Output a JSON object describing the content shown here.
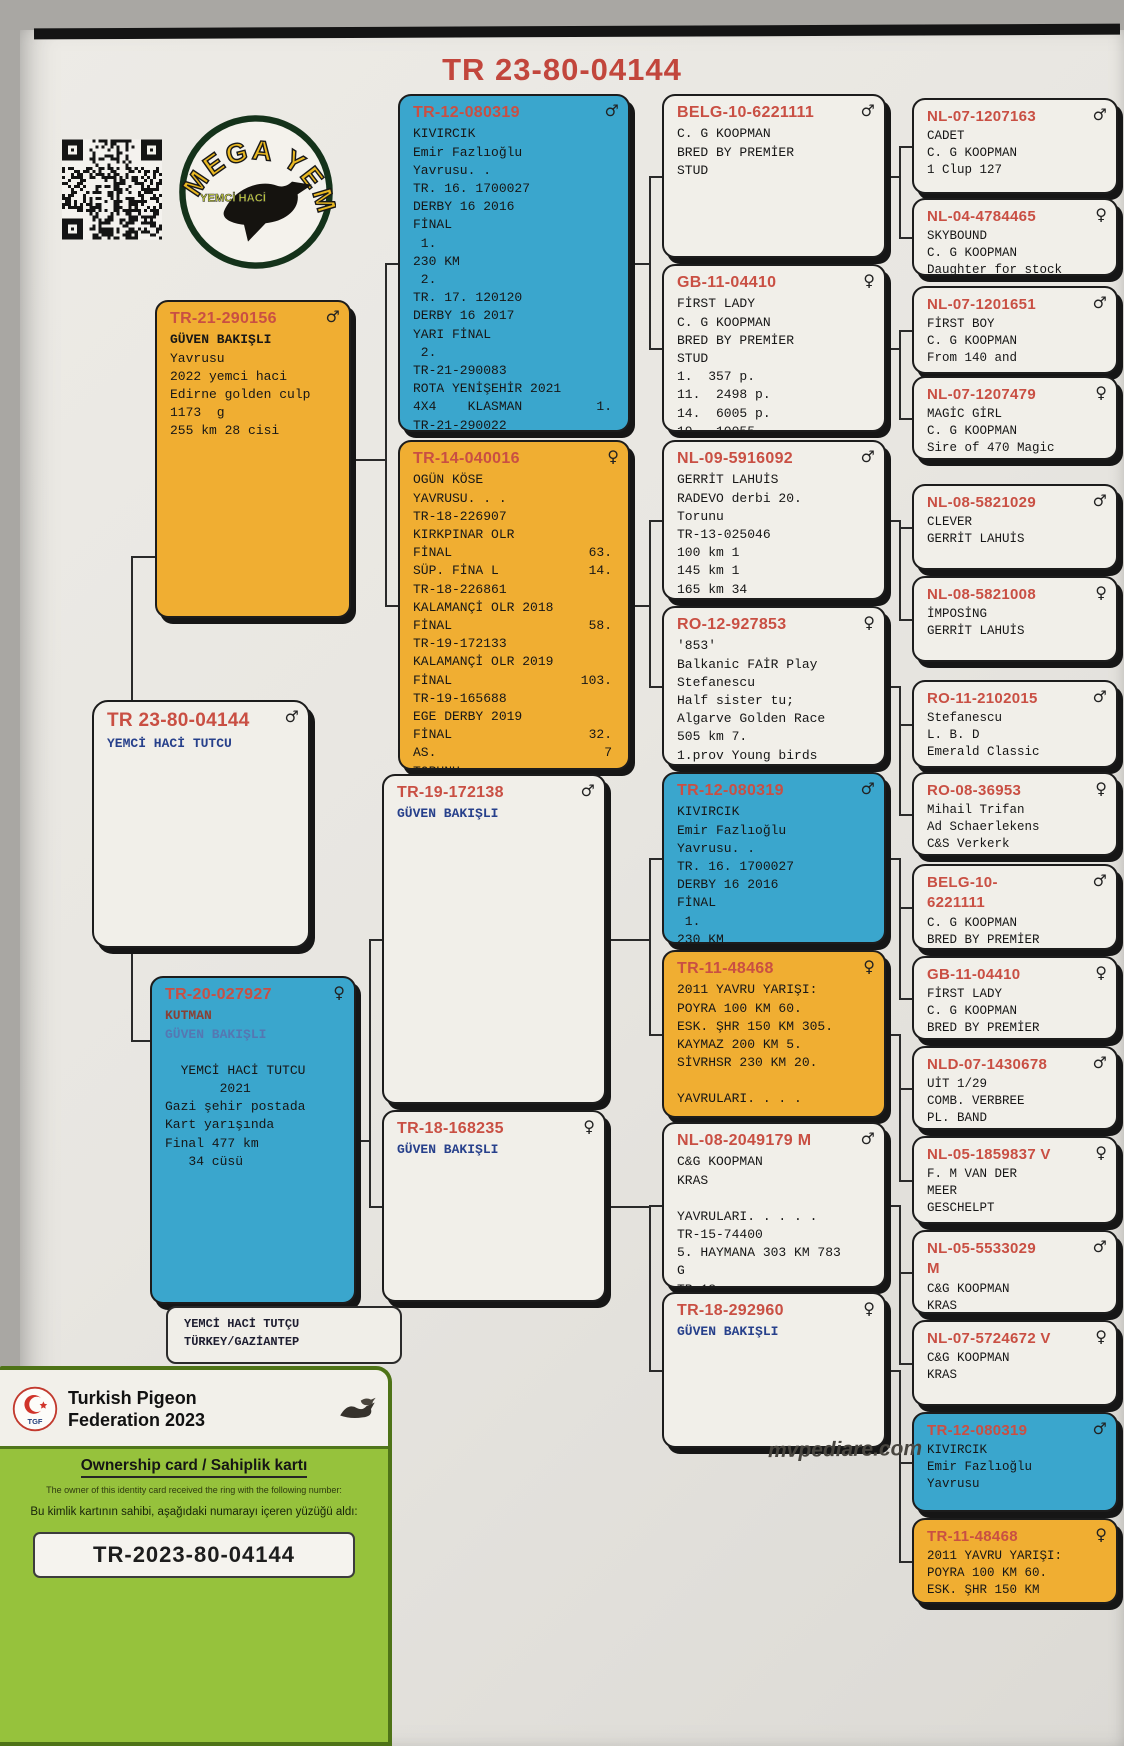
{
  "page": {
    "title": "TR 23-80-04144",
    "site": "mvpediare.com"
  },
  "logo": {
    "brand_top": "MEGA YEM",
    "brand_bottom": "YEMCİ HACİ"
  },
  "owner_box": {
    "line1": "YEMCİ HACİ TUTÇU",
    "line2": "TÜRKEY/GAZİANTEP"
  },
  "card": {
    "logo_text": "TGF",
    "federation_line1": "Turkish Pigeon",
    "federation_line2": "Federation 2023",
    "ownership_title": "Ownership card / Sahiplik kartı",
    "desc_en": "The owner of this identity card received the ring with the following number:",
    "desc_tr": "Bu kimlik kartının sahibi, aşağıdaki numarayı içeren yüzüğü aldı:",
    "ring_number": "TR-2023-80-04144"
  },
  "colors": {
    "blue": "#3aa6cd",
    "orange": "#f0ae32",
    "ring_red": "#c94f43",
    "navy": "#27408b"
  },
  "pedigree": {
    "extra_segments": [
      {
        "o": "v",
        "x": 131,
        "y": 556,
        "len": 146
      },
      {
        "o": "h",
        "x": 131,
        "y": 556,
        "len": 24
      },
      {
        "o": "v",
        "x": 131,
        "y": 948,
        "len": 92
      },
      {
        "o": "h",
        "x": 131,
        "y": 1040,
        "len": 20
      }
    ],
    "boxes": [
      {
        "id": "b1",
        "col": 1,
        "color": "orange",
        "sex": "m",
        "x": 155,
        "y": 300,
        "w": 196,
        "h": 318,
        "ring": "TR-21-290156",
        "parents": [
          "b4",
          "b5"
        ],
        "lines": [
          {
            "t": "GÜVEN BAKIŞLI",
            "s": "bold"
          },
          {
            "t": "Yavrusu"
          },
          {
            "t": "2022 yemci haci"
          },
          {
            "t": "Edirne golden culp"
          },
          {
            "t": "1173  g"
          },
          {
            "t": "255 km 28 cisi"
          }
        ]
      },
      {
        "id": "b2",
        "col": 1,
        "color": "white",
        "sex": "m",
        "x": 92,
        "y": 700,
        "w": 218,
        "h": 248,
        "rs": 19,
        "ring": "TR 23-80-04144",
        "parents": [],
        "lines": [
          {
            "t": "YEMCİ HACİ TUTCU",
            "s": "navy"
          }
        ]
      },
      {
        "id": "b3",
        "col": 1,
        "color": "blue",
        "sex": "f",
        "x": 150,
        "y": 976,
        "w": 206,
        "h": 328,
        "ring": "TR-20-027927",
        "parents": [
          "b6",
          "b7"
        ],
        "lines": [
          {
            "t": "KUTMAN",
            "s": "darkred"
          },
          {
            "t": "GÜVEN BAKIŞLI",
            "s": "navyfade"
          },
          {
            "t": ""
          },
          {
            "t": "  YEMCİ HACİ TUTCU"
          },
          {
            "t": "       2021"
          },
          {
            "t": "Gazi şehir postada"
          },
          {
            "t": "Kart yarışında"
          },
          {
            "t": "Final 477 km"
          },
          {
            "t": "   34 cüsü"
          }
        ]
      },
      {
        "id": "b4",
        "col": 2,
        "color": "blue",
        "sex": "m",
        "x": 398,
        "y": 94,
        "w": 232,
        "h": 338,
        "ring": "TR-12-080319",
        "parents": [
          "b8",
          "b9"
        ],
        "lines": [
          {
            "t": "KIVIRCIK"
          },
          {
            "t": "Emir Fazlıoğlu"
          },
          {
            "t": "Yavrusu. ."
          },
          {
            "t": "TR. 16. 1700027"
          },
          {
            "t": "DERBY 16 2016"
          },
          {
            "t": "FİNAL"
          },
          {
            "t": " 1."
          },
          {
            "t": "230 KM"
          },
          {
            "t": " 2."
          },
          {
            "t": "TR. 17. 120120"
          },
          {
            "t": "DERBY 16 2017"
          },
          {
            "t": "YARI FİNAL"
          },
          {
            "t": " 2."
          },
          {
            "t": "TR-21-290083"
          },
          {
            "t": "ROTA YENİŞEHİR 2021"
          },
          {
            "t": "4X4    KLASMAN",
            "r": "1."
          },
          {
            "t": "TR-21-290022"
          }
        ]
      },
      {
        "id": "b5",
        "col": 2,
        "color": "orange",
        "sex": "f",
        "x": 398,
        "y": 440,
        "w": 232,
        "h": 330,
        "ring": "TR-14-040016",
        "parents": [
          "b10",
          "b11"
        ],
        "lines": [
          {
            "t": "OGÜN KÖSE"
          },
          {
            "t": "YAVRUSU. . ."
          },
          {
            "t": "TR-18-226907"
          },
          {
            "t": "KIRKPINAR OLR"
          },
          {
            "t": "FİNAL",
            "r": "63."
          },
          {
            "t": "SÜP. FİNA L",
            "r": "14."
          },
          {
            "t": "TR-18-226861"
          },
          {
            "t": "KALAMANÇİ OLR 2018"
          },
          {
            "t": "FİNAL",
            "r": "58."
          },
          {
            "t": "TR-19-172133"
          },
          {
            "t": "KALAMANÇİ OLR 2019"
          },
          {
            "t": "FİNAL",
            "r": "103."
          },
          {
            "t": "TR-19-165688"
          },
          {
            "t": "EGE DERBY 2019"
          },
          {
            "t": "FİNAL",
            "r": "32."
          },
          {
            "t": "AS.",
            "r": "7"
          },
          {
            "t": "TORUNU"
          }
        ]
      },
      {
        "id": "b6",
        "col": 2,
        "color": "white",
        "sex": "m",
        "x": 382,
        "y": 774,
        "w": 224,
        "h": 330,
        "ring": "TR-19-172138",
        "parents": [
          "b12",
          "b13"
        ],
        "lines": [
          {
            "t": "GÜVEN BAKIŞLI",
            "s": "navy"
          }
        ]
      },
      {
        "id": "b7",
        "col": 2,
        "color": "white",
        "sex": "f",
        "x": 382,
        "y": 1110,
        "w": 224,
        "h": 192,
        "ring": "TR-18-168235",
        "parents": [
          "b14",
          "b15"
        ],
        "lines": [
          {
            "t": "GÜVEN BAKIŞLI",
            "s": "navy"
          }
        ]
      },
      {
        "id": "b8",
        "col": 3,
        "color": "white",
        "sex": "m",
        "x": 662,
        "y": 94,
        "w": 224,
        "h": 164,
        "ring": "BELG-10-6221111",
        "parents": [
          "b16",
          "b17"
        ],
        "lines": [
          {
            "t": "C. G KOOPMAN"
          },
          {
            "t": "BRED BY PREMİER"
          },
          {
            "t": "STUD"
          }
        ]
      },
      {
        "id": "b9",
        "col": 3,
        "color": "white",
        "sex": "f",
        "x": 662,
        "y": 264,
        "w": 224,
        "h": 168,
        "ring": "GB-11-04410",
        "parents": [
          "b18",
          "b19"
        ],
        "lines": [
          {
            "t": "FİRST LADY"
          },
          {
            "t": "C. G KOOPMAN"
          },
          {
            "t": "BRED BY PREMİER"
          },
          {
            "t": "STUD"
          },
          {
            "t": "1.  357 p."
          },
          {
            "t": "11.  2498 p."
          },
          {
            "t": "14.  6005 p."
          },
          {
            "t": "19.  10055",
            "s": "cut"
          }
        ]
      },
      {
        "id": "b10",
        "col": 3,
        "color": "white",
        "sex": "m",
        "x": 662,
        "y": 440,
        "w": 224,
        "h": 160,
        "ring": "NL-09-5916092",
        "parents": [
          "b20",
          "b21"
        ],
        "lines": [
          {
            "t": "GERRİT LAHUİS"
          },
          {
            "t": "RADEVO derbi 20."
          },
          {
            "t": "Torunu"
          },
          {
            "t": "TR-13-025046"
          },
          {
            "t": "100 km 1"
          },
          {
            "t": "145 km 1"
          },
          {
            "t": "165 km 34"
          },
          {
            "t": "345 km 15",
            "s": "cut"
          }
        ]
      },
      {
        "id": "b11",
        "col": 3,
        "color": "white",
        "sex": "f",
        "x": 662,
        "y": 606,
        "w": 224,
        "h": 160,
        "ring": "RO-12-927853",
        "parents": [
          "b22",
          "b23"
        ],
        "lines": [
          {
            "t": "'853'"
          },
          {
            "t": "Balkanic FAİR Play"
          },
          {
            "t": "Stefanescu"
          },
          {
            "t": "Half sister tu;"
          },
          {
            "t": "Algarve Golden Race"
          },
          {
            "t": "505 km 7."
          },
          {
            "t": "1.prov Young birds"
          },
          {
            "t": "2022",
            "s": "cut"
          }
        ]
      },
      {
        "id": "b12",
        "col": 3,
        "color": "blue",
        "sex": "m",
        "x": 662,
        "y": 772,
        "w": 224,
        "h": 172,
        "ring": "TR-12-080319",
        "parents": [
          "b24",
          "b25"
        ],
        "lines": [
          {
            "t": "KIVIRCIK"
          },
          {
            "t": "Emir Fazlıoğlu"
          },
          {
            "t": "Yavrusu. ."
          },
          {
            "t": "TR. 16. 1700027"
          },
          {
            "t": "DERBY 16 2016"
          },
          {
            "t": "FİNAL"
          },
          {
            "t": " 1."
          },
          {
            "t": "230 KM",
            "s": "cut"
          }
        ]
      },
      {
        "id": "b13",
        "col": 3,
        "color": "orange",
        "sex": "f",
        "x": 662,
        "y": 950,
        "w": 224,
        "h": 168,
        "ring": "TR-11-48468",
        "parents": [
          "b26",
          "b27"
        ],
        "lines": [
          {
            "t": "2011 YAVRU YARIŞI:"
          },
          {
            "t": "POYRA 100 KM 60."
          },
          {
            "t": "ESK. ŞHR 150 KM 305."
          },
          {
            "t": "KAYMAZ 200 KM 5."
          },
          {
            "t": "SİVRHSR 230 KM 20."
          },
          {
            "t": ""
          },
          {
            "t": "YAVRULARI. . . ."
          }
        ]
      },
      {
        "id": "b14",
        "col": 3,
        "color": "white",
        "sex": "m",
        "x": 662,
        "y": 1122,
        "w": 224,
        "h": 166,
        "ring": "NL-08-2049179 M",
        "parents": [
          "b28",
          "b29"
        ],
        "lines": [
          {
            "t": "C&G KOOPMAN"
          },
          {
            "t": "KRAS"
          },
          {
            "t": ""
          },
          {
            "t": "YAVRULARI. . . . ."
          },
          {
            "t": "TR-15-74400"
          },
          {
            "t": "5. HAYMANA 303 KM 783"
          },
          {
            "t": "G"
          },
          {
            "t": "TR-18-...",
            "s": "cut"
          }
        ]
      },
      {
        "id": "b15",
        "col": 3,
        "color": "white",
        "sex": "f",
        "x": 662,
        "y": 1292,
        "w": 224,
        "h": 156,
        "ring": "TR-18-292960",
        "parents": [
          "b30",
          "b31"
        ],
        "lines": [
          {
            "t": "GÜVEN BAKIŞLI",
            "s": "navy"
          }
        ]
      },
      {
        "id": "b16",
        "col": 4,
        "color": "white",
        "sex": "m",
        "x": 912,
        "y": 98,
        "w": 206,
        "h": 96,
        "ring": "NL-07-1207163",
        "parents": [],
        "lines": [
          {
            "t": "CADET"
          },
          {
            "t": "C. G KOOPMAN"
          },
          {
            "t": "1 Clup 127",
            "s": "cut"
          }
        ]
      },
      {
        "id": "b17",
        "col": 4,
        "color": "white",
        "sex": "f",
        "x": 912,
        "y": 198,
        "w": 206,
        "h": 78,
        "ring": "NL-04-4784465",
        "parents": [],
        "lines": [
          {
            "t": "SKYBOUND"
          },
          {
            "t": "C. G KOOPMAN"
          },
          {
            "t": "Daughter for stock",
            "s": "cut"
          }
        ]
      },
      {
        "id": "b18",
        "col": 4,
        "color": "white",
        "sex": "m",
        "x": 912,
        "y": 286,
        "w": 206,
        "h": 88,
        "ring": "NL-07-1201651",
        "parents": [],
        "lines": [
          {
            "t": "FİRST BOY"
          },
          {
            "t": "C. G KOOPMAN"
          },
          {
            "t": "From 140 and",
            "s": "cut"
          }
        ]
      },
      {
        "id": "b19",
        "col": 4,
        "color": "white",
        "sex": "f",
        "x": 912,
        "y": 376,
        "w": 206,
        "h": 84,
        "ring": "NL-07-1207479",
        "parents": [],
        "lines": [
          {
            "t": "MAGİC GİRL"
          },
          {
            "t": "C. G KOOPMAN"
          },
          {
            "t": "Sire of 470 Magic",
            "s": "cut"
          }
        ]
      },
      {
        "id": "b20",
        "col": 4,
        "color": "white",
        "sex": "m",
        "x": 912,
        "y": 484,
        "w": 206,
        "h": 86,
        "ring": "NL-08-5821029",
        "parents": [],
        "lines": [
          {
            "t": "CLEVER"
          },
          {
            "t": "GERRİT LAHUİS"
          }
        ]
      },
      {
        "id": "b21",
        "col": 4,
        "color": "white",
        "sex": "f",
        "x": 912,
        "y": 576,
        "w": 206,
        "h": 86,
        "ring": "NL-08-5821008",
        "parents": [],
        "lines": [
          {
            "t": "İMPOSİNG"
          },
          {
            "t": "GERRİT LAHUİS"
          }
        ]
      },
      {
        "id": "b22",
        "col": 4,
        "color": "white",
        "sex": "m",
        "x": 912,
        "y": 680,
        "w": 206,
        "h": 88,
        "ring": "RO-11-2102015",
        "parents": [],
        "lines": [
          {
            "t": "Stefanescu"
          },
          {
            "t": "L. B. D"
          },
          {
            "t": "Emerald Classic",
            "s": "cut"
          }
        ]
      },
      {
        "id": "b23",
        "col": 4,
        "color": "white",
        "sex": "f",
        "x": 912,
        "y": 772,
        "w": 206,
        "h": 84,
        "ring": "RO-08-36953",
        "parents": [],
        "lines": [
          {
            "t": "Mihail Trifan"
          },
          {
            "t": "Ad Schaerlekens"
          },
          {
            "t": "C&S Verkerk",
            "s": "cut"
          }
        ]
      },
      {
        "id": "b24",
        "col": 4,
        "color": "white",
        "sex": "m",
        "x": 912,
        "y": 864,
        "w": 206,
        "h": 86,
        "ring": "BELG-10-",
        "ring2": "6221111",
        "parents": [],
        "lines": [
          {
            "t": "C. G KOOPMAN"
          },
          {
            "t": "BRED BY PREMİER",
            "s": "cut"
          }
        ]
      },
      {
        "id": "b25",
        "col": 4,
        "color": "white",
        "sex": "f",
        "x": 912,
        "y": 956,
        "w": 206,
        "h": 84,
        "ring": "GB-11-04410",
        "parents": [],
        "lines": [
          {
            "t": "FİRST LADY"
          },
          {
            "t": "C. G KOOPMAN"
          },
          {
            "t": "BRED BY PREMİER",
            "s": "cut"
          }
        ]
      },
      {
        "id": "b26",
        "col": 4,
        "color": "white",
        "sex": "m",
        "x": 912,
        "y": 1046,
        "w": 206,
        "h": 84,
        "ring": "NLD-07-1430678",
        "parents": [],
        "lines": [
          {
            "t": "UİT 1/29"
          },
          {
            "t": "COMB. VERBREE"
          },
          {
            "t": "PL. BAND",
            "s": "cut"
          }
        ]
      },
      {
        "id": "b27",
        "col": 4,
        "color": "white",
        "sex": "f",
        "x": 912,
        "y": 1136,
        "w": 206,
        "h": 88,
        "ring": "NL-05-1859837 V",
        "parents": [],
        "lines": [
          {
            "t": "F. M VAN DER"
          },
          {
            "t": "MEER"
          },
          {
            "t": "GESCHELPT",
            "s": "cut"
          }
        ]
      },
      {
        "id": "b28",
        "col": 4,
        "color": "white",
        "sex": "m",
        "x": 912,
        "y": 1230,
        "w": 206,
        "h": 84,
        "ring": "NL-05-5533029",
        "ring2": "M",
        "parents": [],
        "lines": [
          {
            "t": "C&G KOOPMAN"
          },
          {
            "t": "KRAS",
            "s": "cut"
          }
        ]
      },
      {
        "id": "b29",
        "col": 4,
        "color": "white",
        "sex": "f",
        "x": 912,
        "y": 1320,
        "w": 206,
        "h": 86,
        "ring": "NL-07-5724672 V",
        "parents": [],
        "lines": [
          {
            "t": "C&G KOOPMAN"
          },
          {
            "t": "KRAS"
          }
        ]
      },
      {
        "id": "b30",
        "col": 4,
        "color": "blue",
        "sex": "m",
        "x": 912,
        "y": 1412,
        "w": 206,
        "h": 100,
        "ring": "TR-12-080319",
        "parents": [],
        "lines": [
          {
            "t": "KIVIRCIK"
          },
          {
            "t": "Emir Fazlıoğlu"
          },
          {
            "t": "Yavrusu",
            "s": "cut"
          }
        ]
      },
      {
        "id": "b31",
        "col": 4,
        "color": "orange",
        "sex": "f",
        "x": 912,
        "y": 1518,
        "w": 206,
        "h": 86,
        "ring": "TR-11-48468",
        "parents": [],
        "lines": [
          {
            "t": "2011 YAVRU YARIŞI:"
          },
          {
            "t": "POYRA 100 KM 60."
          },
          {
            "t": "ESK. ŞHR 150 KM",
            "s": "cut"
          }
        ]
      }
    ]
  }
}
